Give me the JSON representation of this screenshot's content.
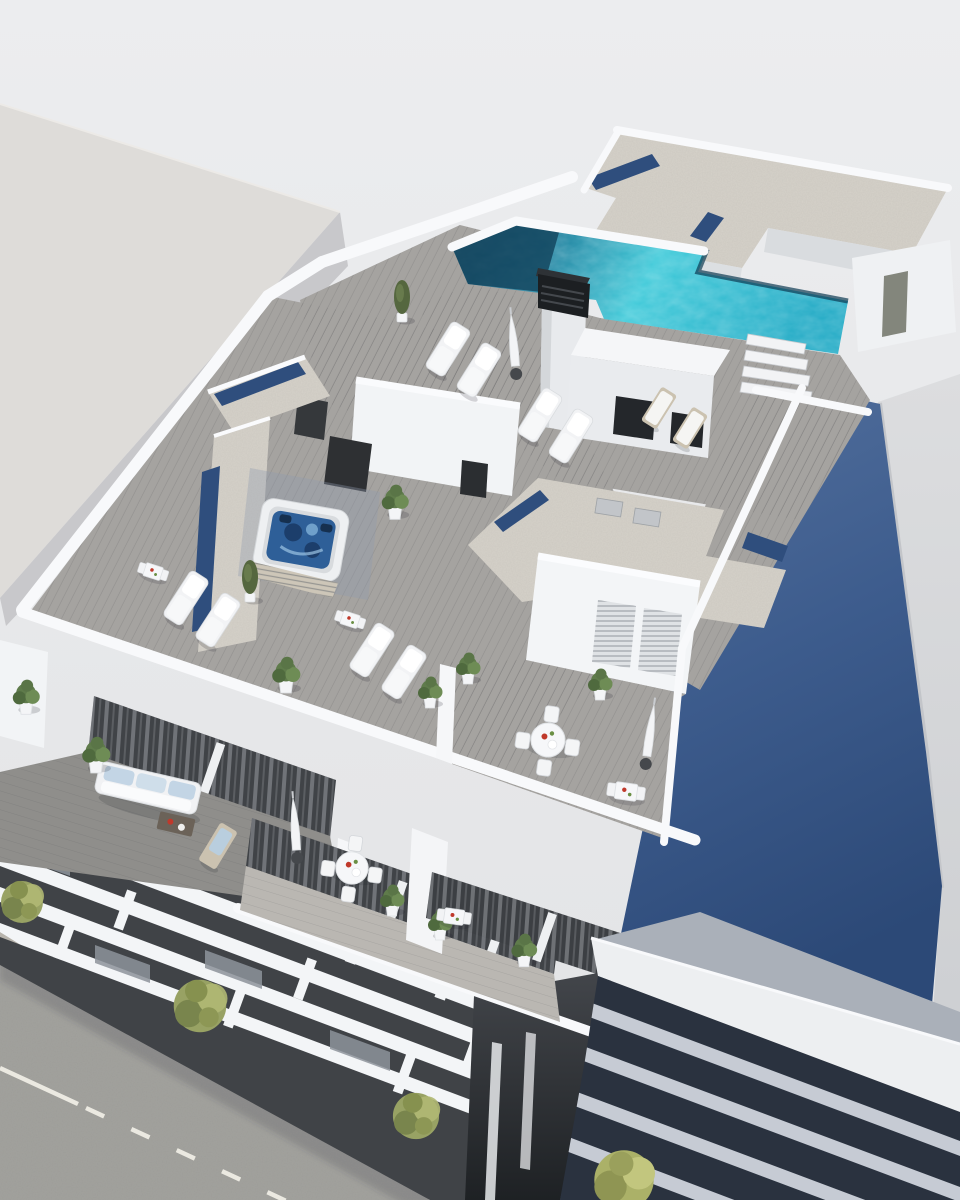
{
  "scene": {
    "type": "3d-architectural-rendering",
    "view": "aerial-axonometric",
    "subject": "white residential apartment building with rooftop pool, roof terraces, balconies and street"
  },
  "colors": {
    "bgTop": "#ecedef",
    "bgBottom": "#e2e3e5",
    "leftRoof": "#dedcd9",
    "leftWall": "#c8c8cb",
    "rightBldg": "#d8d9db",
    "rightShade": "#c3c5c9",
    "blueTop": "#54719e",
    "blueMid": "#3d5c8d",
    "blueBottom": "#2c4977",
    "white": "#f3f5f7",
    "whiteBright": "#fafbfd",
    "wallShade": "#d9dcdf",
    "gravel": "#d6d2ca",
    "skylight": "#2f4e7d",
    "poolBright": "#40cad9",
    "poolMid": "#1fa9c4",
    "poolDeep": "#136a8c",
    "poolDark": "#123f5c",
    "deck": "#a5a3a0",
    "deckDark": "#8f8e8b",
    "deckLight": "#bab7b2",
    "facade": "#404347",
    "glassDark": "#24272b",
    "road": "#9d9d99",
    "sidewalk": "#b7b3ab",
    "marking": "#ebe9e1",
    "louverDark": "#2a323f",
    "louverLight": "#c6cbd4",
    "frontRoof": "#edeff1",
    "frontShade": "#aab0b9",
    "alleyTop": "#43464b",
    "alleyBottom": "#1e2124",
    "tree": "#98a264",
    "treeDark": "#79854d",
    "bush": "#abb168",
    "plant": "#5f7b4b",
    "furniture": "#f2f3f5",
    "cushion": "#c3d5e5",
    "wood": "#cbc2b0",
    "chimney": "#1c1f22",
    "jacuzziWater": "#2e5f98"
  }
}
